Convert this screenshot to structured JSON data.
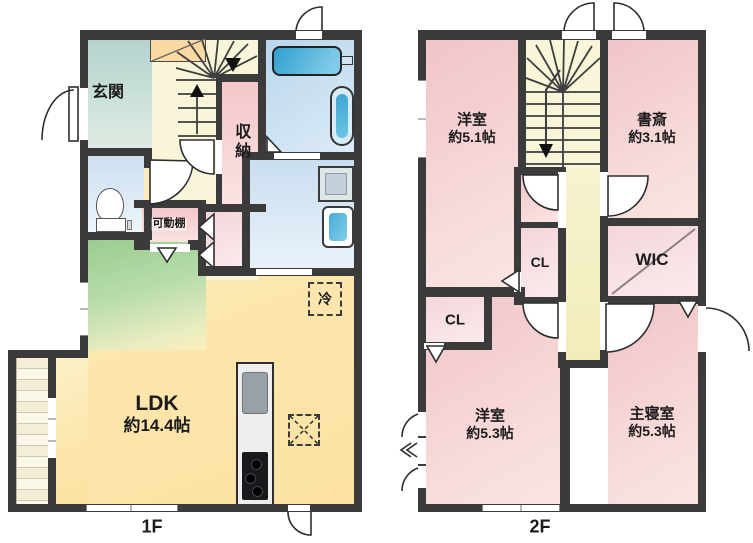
{
  "floor1": {
    "caption": "1F",
    "rooms": {
      "genkan": "玄関",
      "shunou": "収納",
      "kadoudana": "可動棚",
      "rei": "冷",
      "ldk_name": "LDK",
      "ldk_size": "約14.4帖"
    }
  },
  "floor2": {
    "caption": "2F",
    "rooms": {
      "yoshitsu_a_name": "洋室",
      "yoshitsu_a_size": "約5.1帖",
      "shosai_name": "書斎",
      "shosai_size": "約3.1帖",
      "cl_a": "CL",
      "wic": "WIC",
      "cl_b": "CL",
      "yoshitsu_b_name": "洋室",
      "yoshitsu_b_size": "約5.3帖",
      "shushinshitsu_name": "主寝室",
      "shushinshitsu_size": "約5.3帖"
    }
  },
  "colors": {
    "wall": "#3b3b3b",
    "ldk_cream": "#fbe5a8",
    "hall_cream": "#f8f5d8",
    "genkan_teal": "#bcd7d1",
    "hall_green": "#a5d29b",
    "storage_pink": "#f5c8cc",
    "room_pink": "#f3cbcf",
    "closet_pink": "#f8dfe1",
    "bath_blue": "#c6dbee",
    "tub_blue": "#3fa9d5",
    "corridor_yellow": "#f4f1c6",
    "deck_cream": "#f4edd5"
  }
}
